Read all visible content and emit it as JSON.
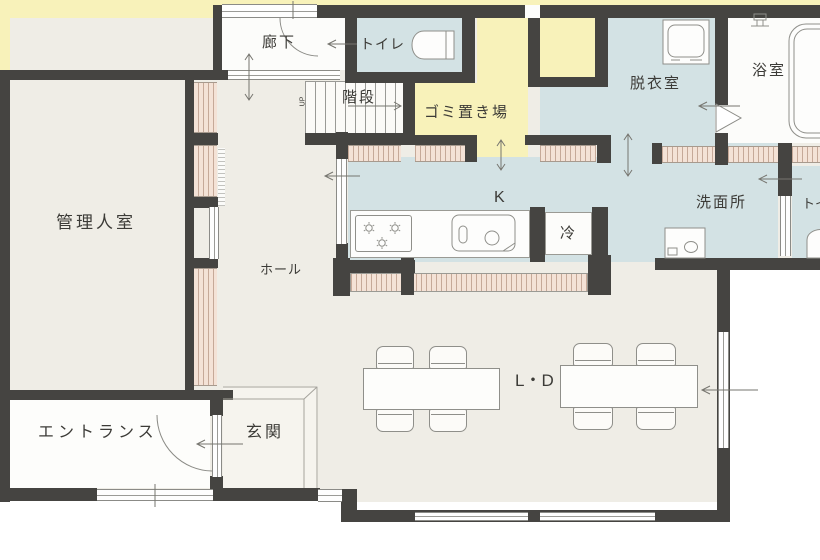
{
  "title": "1F floor plan",
  "rooms": {
    "corridor": "廊下",
    "toilet_north": "トイレ",
    "stairs": "階段",
    "stairs_up": "UP",
    "garbage": "ゴミ置き場",
    "dressing": "脱衣室",
    "bath": "浴室",
    "manager": "管理人室",
    "hall": "ホール",
    "kitchen": "K",
    "fridge": "冷",
    "washroom": "洗面所",
    "toilet_east": "トイレ",
    "entrance": "エントランス",
    "genkan": "玄関",
    "living_dining": "L・D"
  },
  "colors": {
    "wall": "#454441",
    "room_yellow": "#f8f2ba",
    "room_blue": "#d3e2e4",
    "floor": "#efede6",
    "white_room": "#fcfcfa",
    "hatch": "#f4e2d6"
  }
}
